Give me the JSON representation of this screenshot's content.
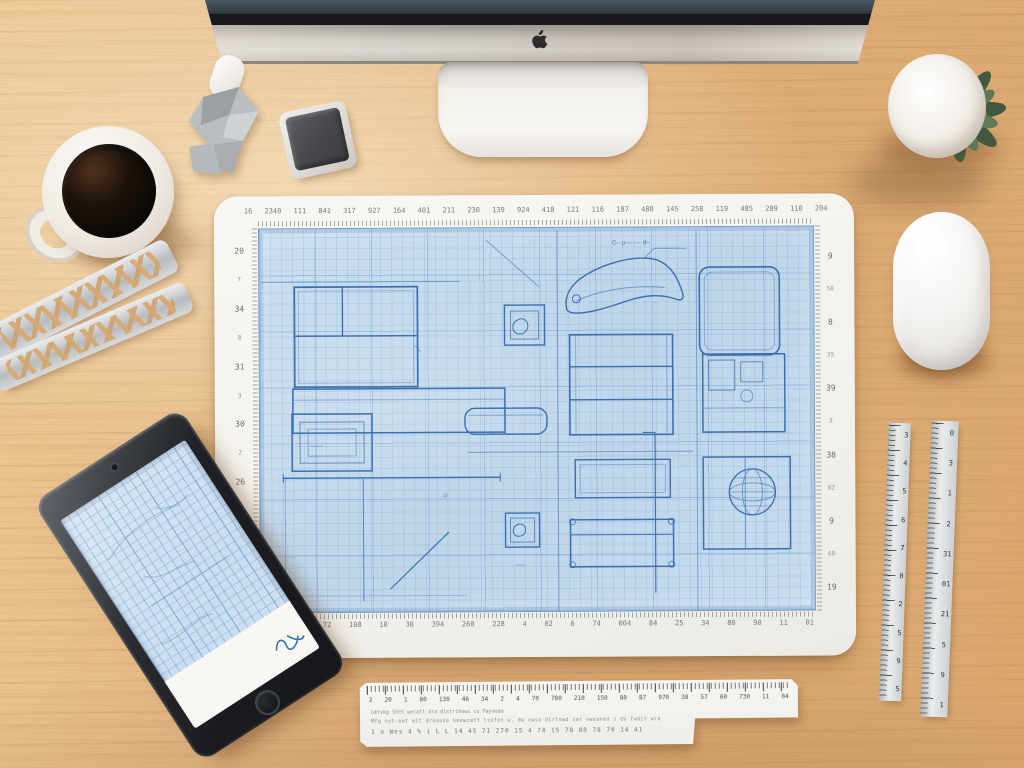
{
  "colors": {
    "wood": "#dfb27c",
    "paper": "#f6f4f0",
    "blueprint_bg": "#c3d9ec",
    "blueprint_line": "#3b6fae",
    "device_black": "#1d1f24",
    "metal": "#cfd2d4",
    "plant_green": "#55704c"
  },
  "sheet": {
    "top_numbers": [
      "16",
      "2340",
      "111",
      "841",
      "317",
      "927",
      "164",
      "401",
      "211",
      "230",
      "139",
      "924",
      "418",
      "121",
      "116",
      "187",
      "480",
      "145",
      "258",
      "119",
      "485",
      "289",
      "110",
      "204"
    ],
    "left_numbers": [
      "20",
      "7",
      "34",
      "8",
      "31",
      "3",
      "30",
      "2",
      "26",
      "4",
      "25",
      "9",
      "23"
    ],
    "right_numbers": [
      "9",
      "50",
      "8",
      "35",
      "39",
      "3",
      "38",
      "02",
      "9",
      "60",
      "19"
    ],
    "bottom_numbers": [
      "2013",
      "104",
      "72",
      "108",
      "10",
      "30",
      "394",
      "260",
      "228",
      "4",
      "02",
      "6",
      "74",
      "004",
      "84",
      "25",
      "34",
      "80",
      "90",
      "11",
      "01"
    ],
    "annotation": "C-- p--- ---- d--"
  },
  "ruler_bottom": {
    "numbers": [
      "2",
      "20",
      "1",
      "80",
      "130",
      "46",
      "34",
      "2",
      "4",
      "70",
      "780",
      "210",
      "150",
      "80",
      "87",
      "970",
      "38",
      "57",
      "60",
      "730",
      "11",
      "04"
    ],
    "text_line1": "Lmtvkg   Stet wecalt dra distrihews cu Fayvwam",
    "text_line2": "Mfg nyt-ewt wit droause keewcatt tssfat w. dw cwsa dirtowd sat oweaned s dv fwdit wra",
    "text_line3": "1 o Wes 4 % i L L 14 45 71 270 15 4 74 15 78 80 78 70 14 41"
  },
  "rulers_right": {
    "ruler1_numbers": [
      "3",
      "4",
      "5",
      "6",
      "7",
      "0",
      "2",
      "5",
      "9",
      "5"
    ],
    "ruler2_numbers": [
      "0",
      "3",
      "1",
      "2",
      "31",
      "01",
      "21",
      "5",
      "9",
      "1"
    ]
  }
}
